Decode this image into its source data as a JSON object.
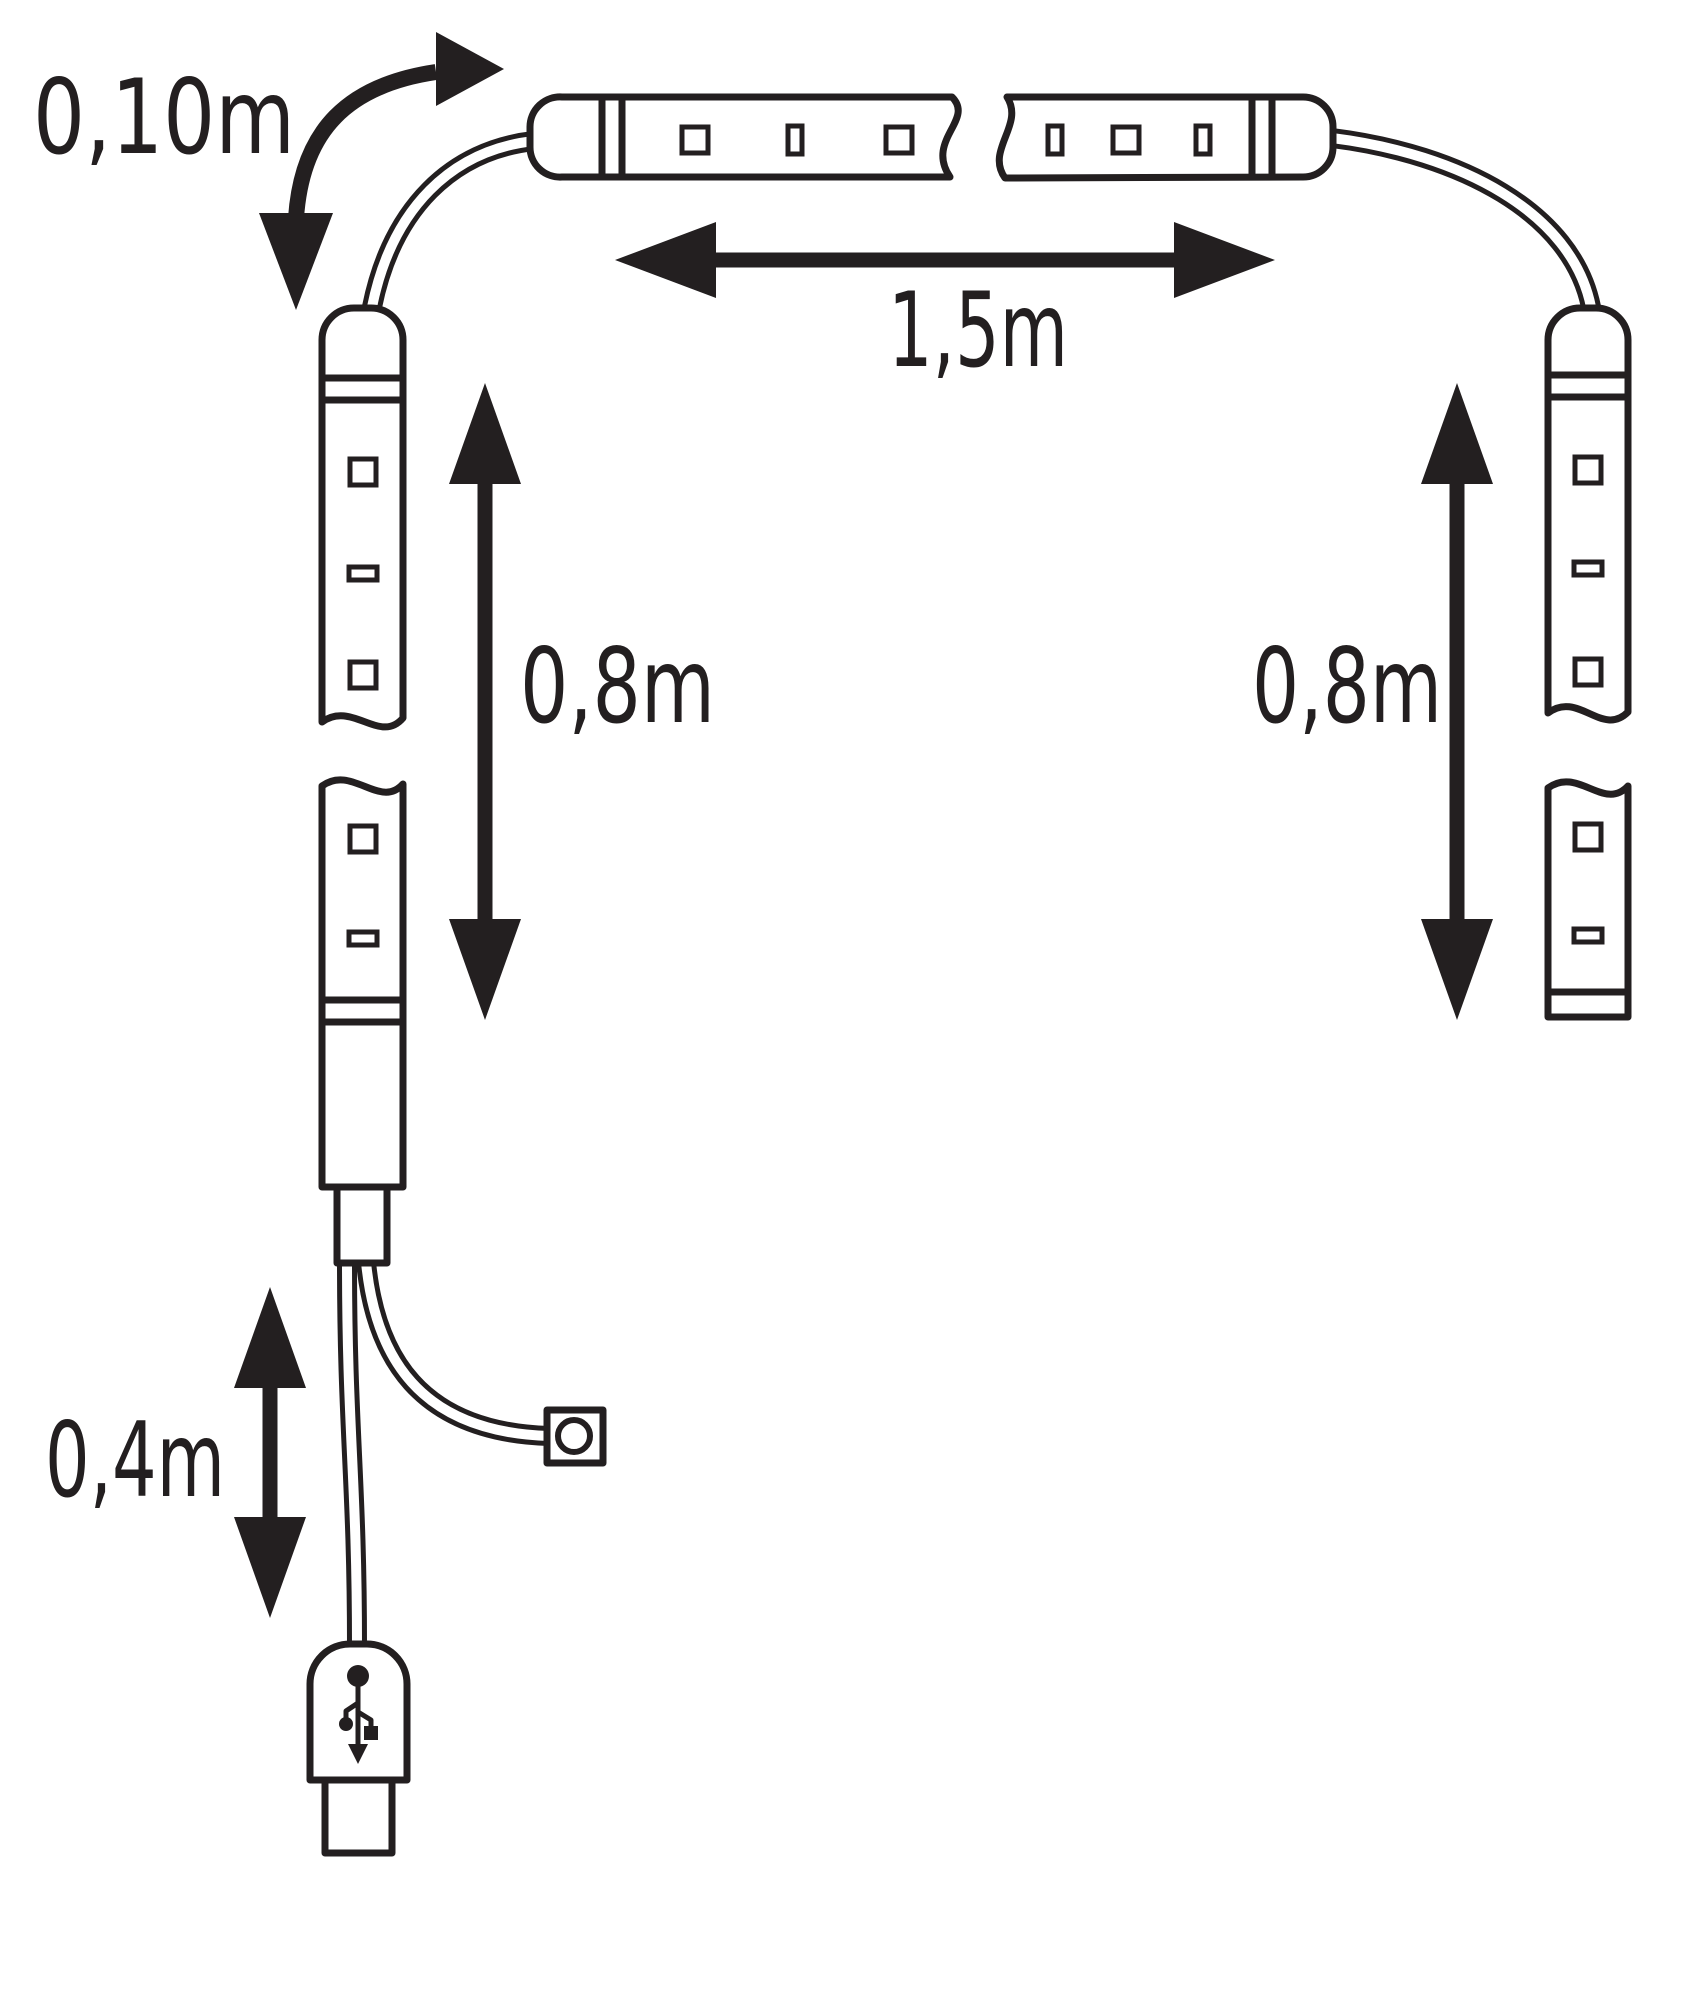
{
  "diagram": {
    "kind": "led-strip-set-dimension-diagram",
    "labels": {
      "connector_cable_top": "0,10m",
      "top_strip": "1,5m",
      "left_strip": "0,8m",
      "right_strip": "0,8m",
      "usb_cable": "0,4m"
    },
    "colors": {
      "line": "#231f20",
      "background": "#ffffff"
    },
    "icons": {
      "usb": "usb-plug-icon",
      "switch": "inline-switch-icon"
    }
  }
}
